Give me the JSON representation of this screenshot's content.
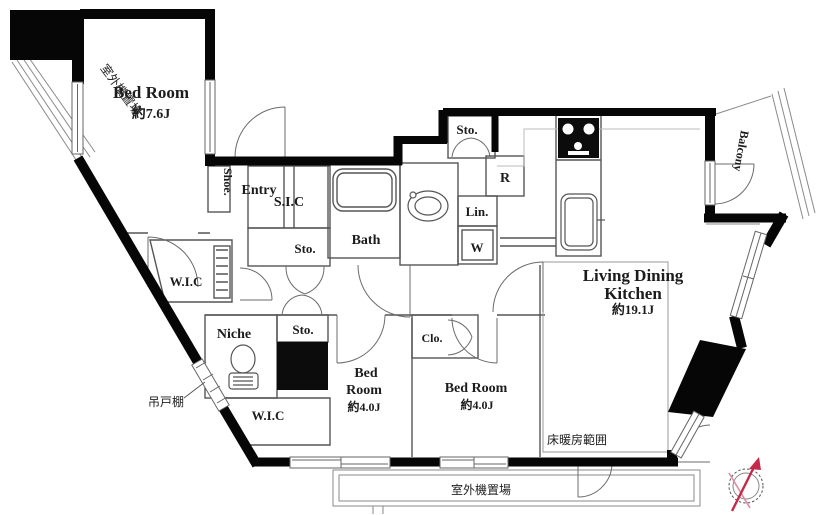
{
  "floorplan": {
    "rooms": {
      "bedroom_main": {
        "name": "Bed Room",
        "size": "約7.6J"
      },
      "bedroom_left": {
        "line1": "Bed",
        "line2": "Room",
        "size": "約4.0J"
      },
      "bedroom_center": {
        "name": "Bed Room",
        "size": "約4.0J"
      },
      "ldk": {
        "line1": "Living Dining",
        "line2": "Kitchen",
        "size": "約19.1J"
      },
      "balcony": {
        "name": "Balcony"
      },
      "bath": {
        "name": "Bath"
      },
      "entry": {
        "name": "Entry"
      },
      "shoe_cabinet": {
        "name": "Shoe."
      },
      "sic": {
        "name": "S.I.C"
      },
      "sto_entry": {
        "name": "Sto."
      },
      "sto_hall": {
        "name": "Sto."
      },
      "sto_kitchen": {
        "name": "Sto."
      },
      "linen": {
        "name": "Lin."
      },
      "washer": {
        "name": "W"
      },
      "fridge": {
        "name": "R"
      },
      "wic_upper": {
        "name": "W.I.C"
      },
      "wic_lower": {
        "name": "W.I.C"
      },
      "niche": {
        "name": "Niche"
      },
      "closet": {
        "name": "Clo."
      }
    },
    "annotations": {
      "outdoor_unit_top": "室外機置場",
      "outdoor_unit_bottom": "室外機置場",
      "floor_heating": "床暖房範囲",
      "hanging_cupboard": "吊戸棚"
    },
    "colors": {
      "wall": "#000000",
      "thin_line": "#777777",
      "compass_needle": "#c42b4a",
      "background": "#ffffff"
    }
  }
}
